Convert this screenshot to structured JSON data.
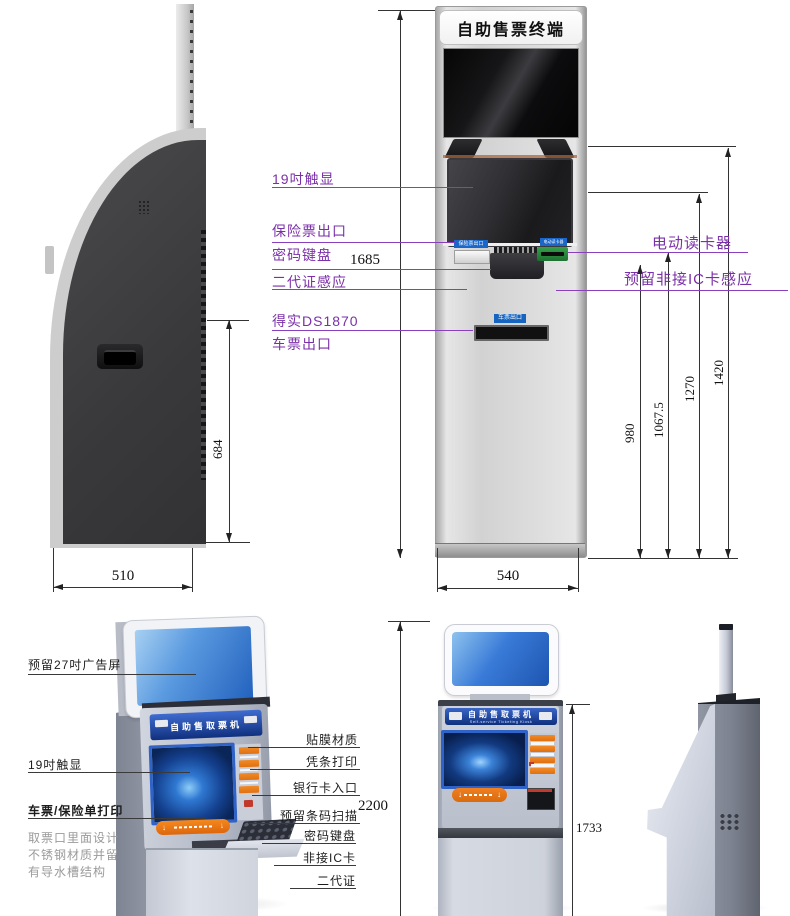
{
  "top": {
    "front": {
      "title": "自助售票终端"
    },
    "callouts_left": [
      "19吋触显",
      "保险票出口",
      "密码键盘",
      "二代证感应",
      "得实DS1870",
      "车票出口"
    ],
    "callouts_right": [
      "电动读卡器",
      "预留非接IC卡感应"
    ],
    "dims": {
      "total_h": "1685",
      "side_h": "684",
      "side_w": "510",
      "front_w": "540",
      "d980": "980",
      "d1067": "1067.5",
      "d1270": "1270",
      "d1420": "1420"
    }
  },
  "bottom": {
    "callouts_left": [
      "预留27吋广告屏",
      "19吋触显",
      "车票/保险单打印"
    ],
    "note": [
      "取票口里面设计",
      "不锈钢材质并留",
      "有导水槽结构"
    ],
    "callouts_mid": [
      "贴膜材质",
      "凭条打印",
      "银行卡入口",
      "预留条码扫描",
      "密码键盘",
      "非接IC卡",
      "二代证"
    ],
    "dims": {
      "total_h": "2200",
      "body_h": "1733"
    },
    "front": {
      "header": "自助售取票机",
      "header_en": "Self-service Ticketing Kiosk"
    },
    "iso": {
      "header": "自助售取票机"
    }
  },
  "colors": {
    "accent_purple": "#7b2fa8",
    "badge_blue": "#1565c0",
    "reader_green": "#2e8b3a",
    "header_blue": "#16377e",
    "slot_orange": "#ee7d1a"
  }
}
